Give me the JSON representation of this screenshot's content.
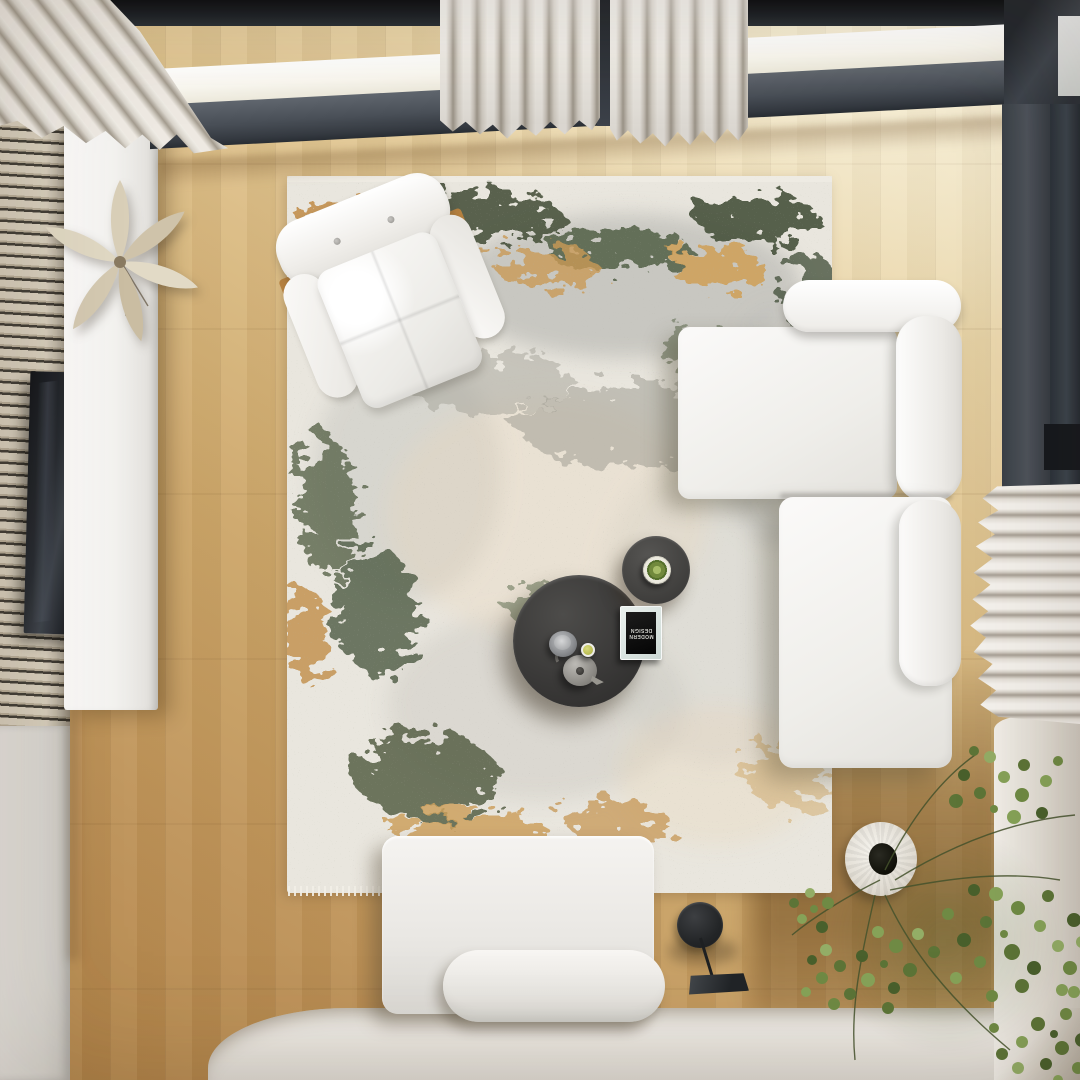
{
  "scene": {
    "description": "Top-down view of a modern living room: white L-shaped sectional sofa, tufted white armchair, two round charcoal coffee tables with teapot and book, distressed abstract rug in ivory, grey, green and ochre, light oak plank floor, skylight with dark grey frames, cream curtains, wood-slat media wall with TV and white console, black disc floor lamp and a sprawling green plant.",
    "book_cover": {
      "line1": "MODERN",
      "line2": "DESIGN"
    },
    "palette": {
      "floor_warm": "#c0955a",
      "floor_pale": "#f3e9cd",
      "frame_dark": "#1d2126",
      "frame_gray": "#4c525a",
      "curtain": "#e7e3db",
      "rug_base": "#e9e6de",
      "rug_green": "#4c573f",
      "rug_ochre": "#c8964f",
      "sofa_white": "#f6f5f2",
      "table_charcoal": "#3c3b39",
      "plant_green": "#6f8a44",
      "wall_beige": "#ddd7cd"
    }
  }
}
